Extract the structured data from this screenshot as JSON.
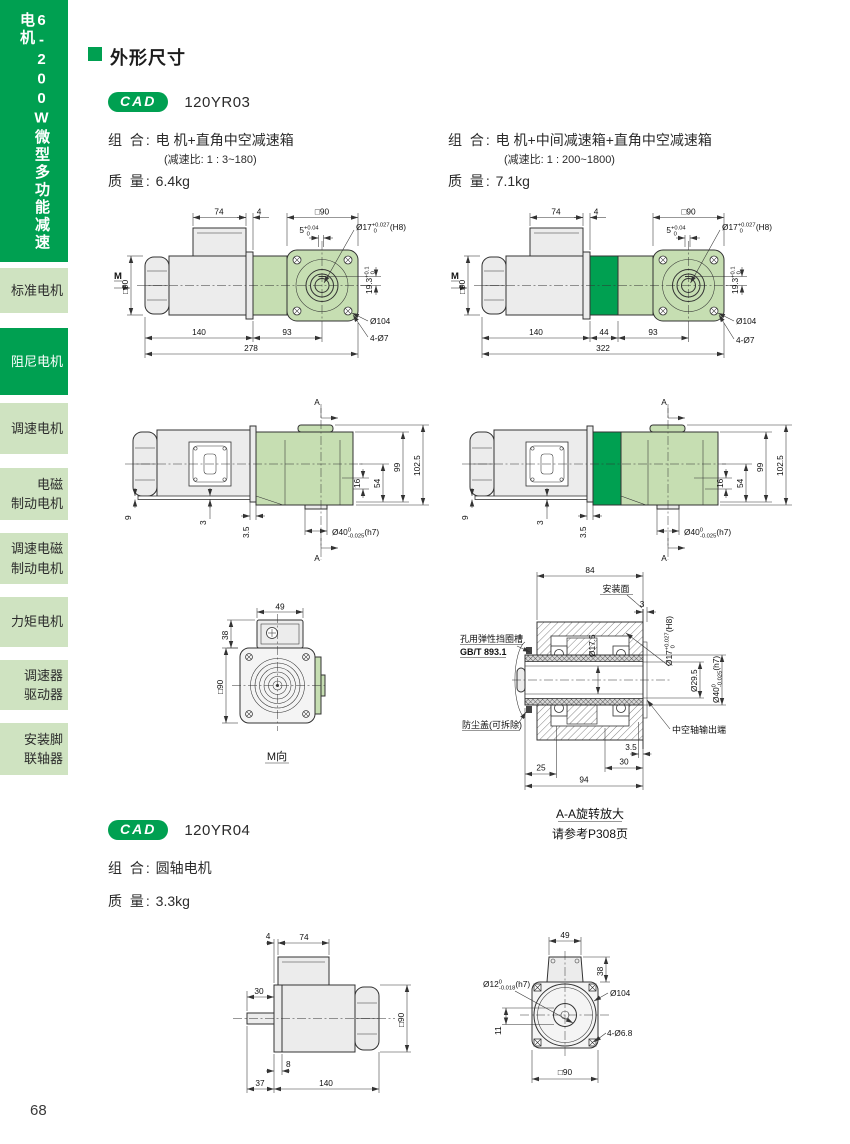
{
  "colors": {
    "green": "#00a051",
    "light_green": "#cfe3c1",
    "draw_green": "#c6deb2"
  },
  "page": {
    "number": "68"
  },
  "sidebar": {
    "series_title": "6-200W微型多功能减速电机",
    "items": [
      {
        "label": "标准电机",
        "active": false
      },
      {
        "label": "阻尼电机",
        "active": true
      },
      {
        "label": "调速电机",
        "active": false
      },
      {
        "label": "电磁\n制动电机",
        "active": false
      },
      {
        "label": "调速电磁\n制动电机",
        "active": false
      },
      {
        "label": "力矩电机",
        "active": false
      },
      {
        "label": "调速器\n驱动器",
        "active": false
      },
      {
        "label": "安装脚\n联轴器",
        "active": false
      }
    ]
  },
  "header": {
    "title": "外形尺寸"
  },
  "cad_label": "CAD",
  "yr03": {
    "code": "120YR03",
    "left": {
      "combo_label": "组 合:",
      "combo": "电 机+直角中空减速箱",
      "ratio": "(减速比: 1 : 3~180)",
      "mass_label": "质 量:",
      "mass": "6.4kg"
    },
    "right": {
      "combo_label": "组 合:",
      "combo": "电 机+中间减速箱+直角中空减速箱",
      "ratio": "(减速比: 1 : 200~1800)",
      "mass_label": "质 量:",
      "mass": "7.1kg"
    }
  },
  "yr04": {
    "code": "120YR04",
    "combo_label": "组 合:",
    "combo": "圆轴电机",
    "mass_label": "质 量:",
    "mass": "3.3kg"
  },
  "dims": {
    "d74": "74",
    "d4": "4",
    "sq90": "□90",
    "d140": "140",
    "d93": "93",
    "d278": "278",
    "d44": "44",
    "d322": "322",
    "d104": "Ø104",
    "d4x7": "4-Ø7",
    "m": "M",
    "a": "A",
    "d9": "9",
    "d3": "3",
    "d3_5": "3.5",
    "d16": "16",
    "d54": "54",
    "d99": "99",
    "d102_5": "102.5",
    "d49": "49",
    "d38": "38",
    "m_view": "M向",
    "d84": "84",
    "mount": "安装面",
    "d17_5": "Ø17.5",
    "d29_5": "Ø29.5",
    "d25": "25",
    "d30": "30",
    "d94": "94",
    "circlip1": "孔用弹性挡圈槽",
    "circlip2": "GB/T 893.1",
    "dust": "防尘盖(可拆除)",
    "hollow": "中空轴输出端",
    "aa1": "A-A旋转放大",
    "aa2": "请参考P308页",
    "d8": "8",
    "d37": "37",
    "d11": "11",
    "d4x68": "4-Ø6.8",
    "tol5": {
      "pre": "5",
      "sup": "+0.04",
      "sub": "0",
      "post": ""
    },
    "tol17": {
      "pre": "Ø17",
      "sup": "+0.027",
      "sub": "0",
      "post": "(H8)"
    },
    "tol19": {
      "pre": "19.3",
      "sup": "+0.1",
      "sub": "0",
      "post": ""
    },
    "tol40": {
      "pre": "Ø40",
      "sup": "0",
      "sub": "-0.025",
      "post": "(h7)"
    },
    "tol12": {
      "pre": "Ø12",
      "sup": "0",
      "sub": "-0.018",
      "post": "(h7)"
    }
  }
}
